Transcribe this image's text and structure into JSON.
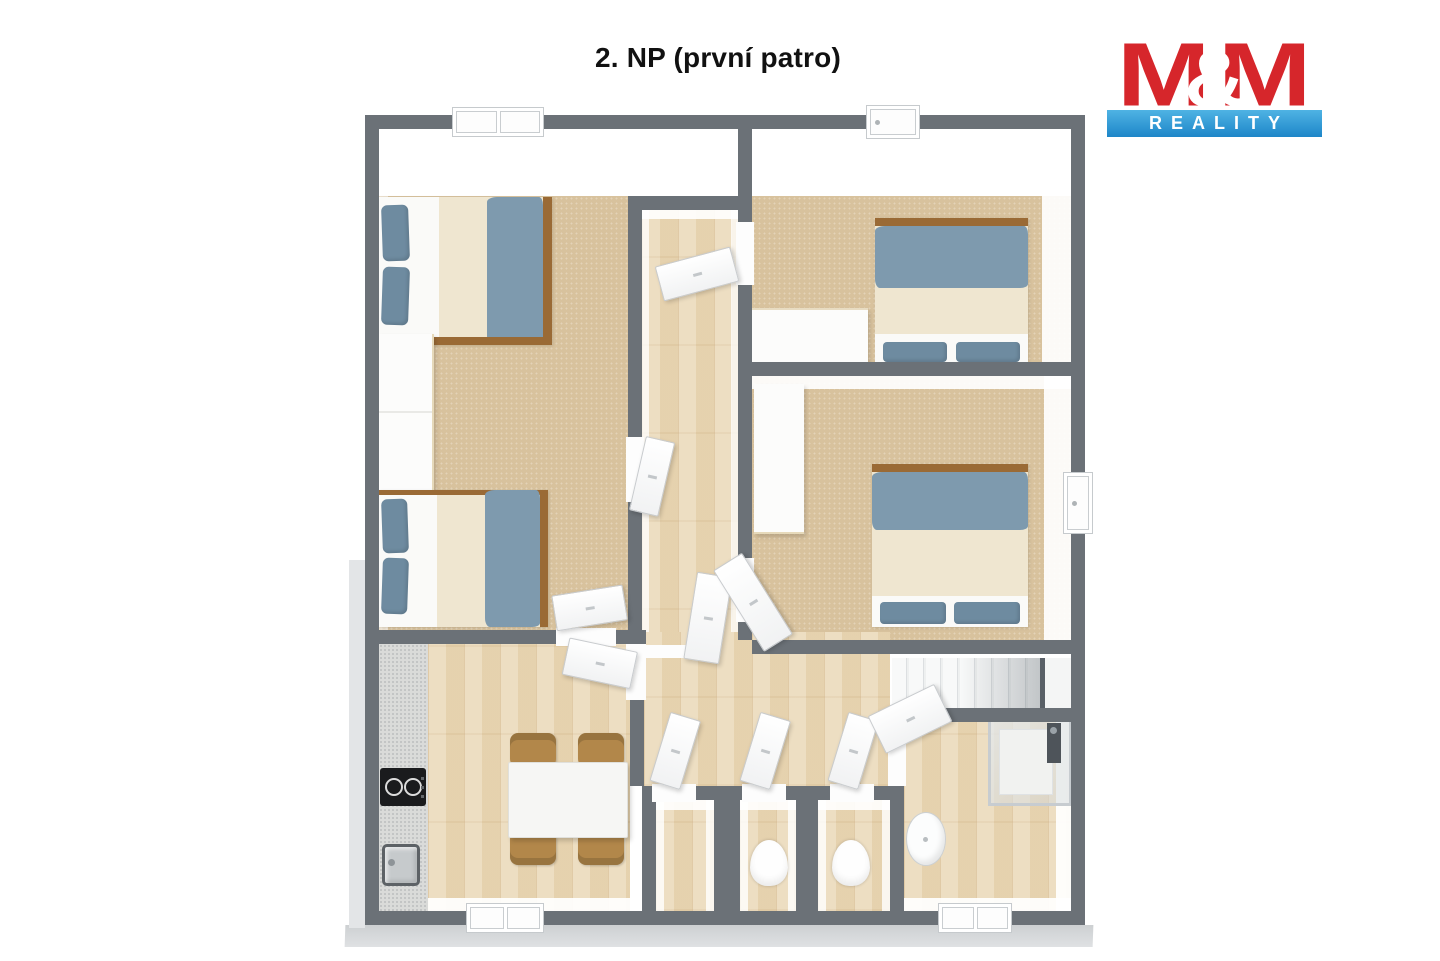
{
  "title": "2. NP (první patro)",
  "logo": {
    "m_left": "M",
    "ampersand": "&",
    "m_right": "M",
    "subtitle": "REALITY"
  },
  "colors": {
    "wall": "#6b7177",
    "carpet": "#d8c29d",
    "wood": "#ead9b8",
    "kitchen_floor": "#dadbd9",
    "blanket": "#7e9aae",
    "pillow": "#6e8ba0",
    "sheet": "#efe6d0",
    "bed_frame": "#9a6a35",
    "chair": "#b2874a",
    "logo_red": "#d6262b",
    "logo_blue": "#1d86c8",
    "slab": "#d3d5d7"
  },
  "plan_objects": {
    "double_beds": 4,
    "wardrobes": 2,
    "desk": 1,
    "dining_table": 1,
    "chairs": 4,
    "toilets": 2,
    "washbasin": 1,
    "kitchen_sink": 1,
    "cooktop": 1,
    "shower": 1,
    "staircase": 1,
    "open_doors": 10,
    "windows": 5
  }
}
